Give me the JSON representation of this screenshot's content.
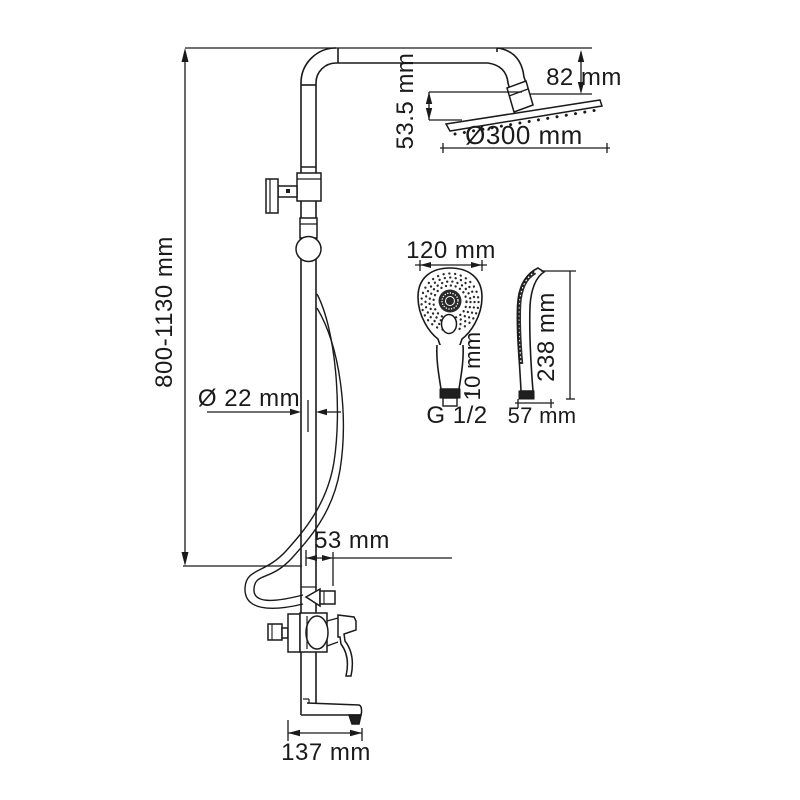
{
  "diagram": {
    "type": "technical-dimension-drawing",
    "colors": {
      "line": "#1a1a1a",
      "background": "#ffffff",
      "dark_fill": "#1f1f1f"
    },
    "labels": {
      "total_height": "800-1130 mm",
      "head_drop": "53.5 mm",
      "head_offset": "82 mm",
      "head_diameter": "Ø300 mm",
      "pipe_diameter": "Ø 22 mm",
      "hose_outlet_offset": "53 mm",
      "spout_length": "137 mm",
      "handshower_width": "120 mm",
      "handshower_connector": "10 mm",
      "handshower_thread": "G 1/2",
      "handshower_length": "238 mm",
      "handshower_depth": "57 mm"
    }
  }
}
